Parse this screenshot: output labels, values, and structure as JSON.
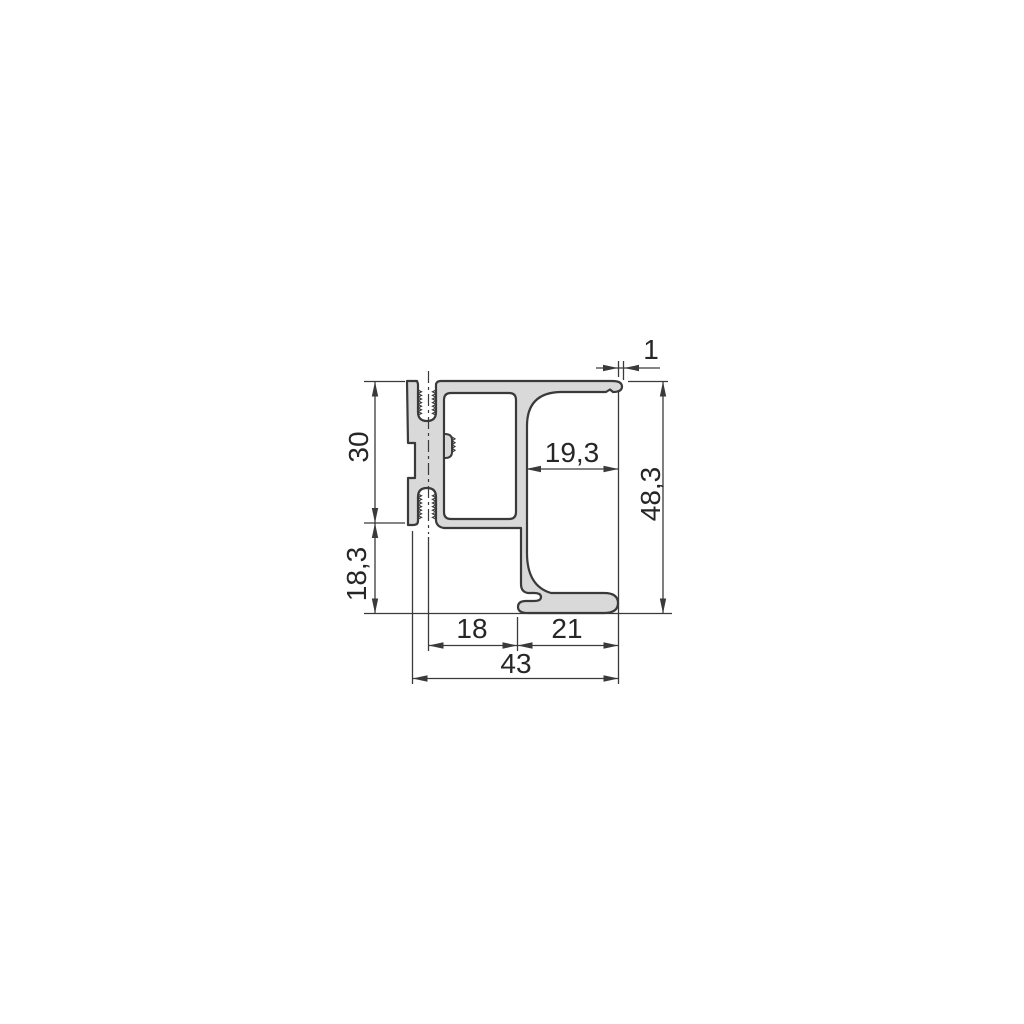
{
  "drawing": {
    "type": "technical-cross-section",
    "subject": "aluminum-extrusion-profile",
    "background_color": "#ffffff",
    "outline_color": "#3a3a3a",
    "material_fill_color": "#d9d9d9",
    "dimension_line_color": "#3a3a3a",
    "centerline_style": "dash-dot",
    "text_color": "#262626",
    "dimensions": [
      {
        "id": "upper-section-height",
        "label": "30",
        "orientation": "vertical"
      },
      {
        "id": "lower-section-height",
        "label": "18,3",
        "orientation": "vertical"
      },
      {
        "id": "overall-height",
        "label": "48,3",
        "orientation": "vertical"
      },
      {
        "id": "channel-inner-width",
        "label": "19,3",
        "orientation": "horizontal"
      },
      {
        "id": "lip-thickness",
        "label": "1",
        "orientation": "horizontal"
      },
      {
        "id": "left-section-width",
        "label": "18",
        "orientation": "horizontal"
      },
      {
        "id": "right-section-width",
        "label": "21",
        "orientation": "horizontal"
      },
      {
        "id": "overall-width",
        "label": "43",
        "orientation": "horizontal"
      }
    ]
  }
}
